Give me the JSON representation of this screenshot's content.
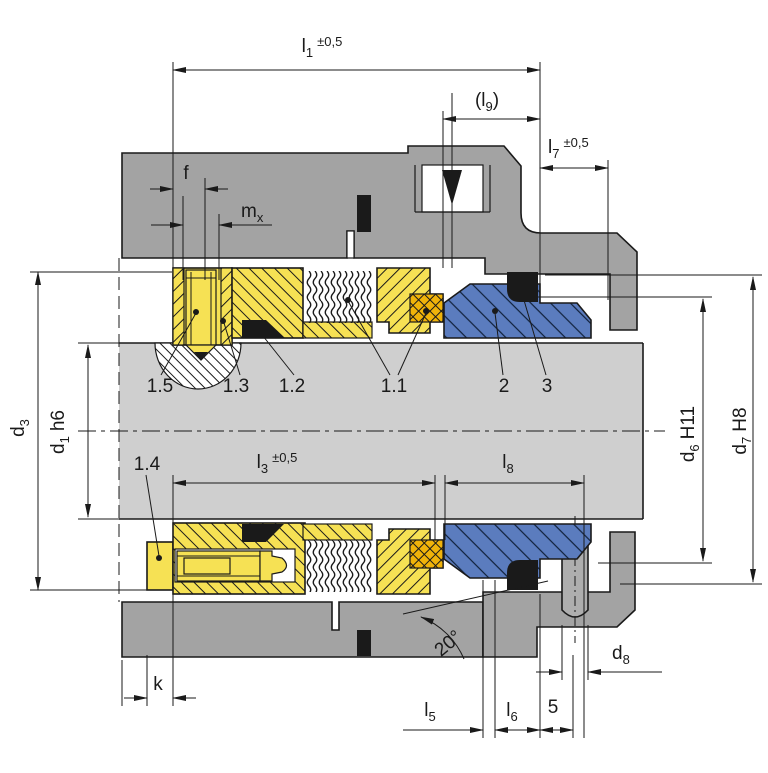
{
  "title": "Mechanical seal sectional drawing",
  "dims": {
    "l1": {
      "base": "l",
      "sub": "1",
      "tol": "±0,5"
    },
    "l9": {
      "pre": "(l",
      "sub": "9",
      "post": ")"
    },
    "l7": {
      "base": "l",
      "sub": "7",
      "tol": "±0,5"
    },
    "l3": {
      "base": "l",
      "sub": "3",
      "tol": "±0,5"
    },
    "l8": {
      "base": "l",
      "sub": "8"
    },
    "l5": {
      "base": "l",
      "sub": "5"
    },
    "l6": {
      "base": "l",
      "sub": "6"
    },
    "dim5": {
      "label": "5"
    },
    "k": {
      "label": "k"
    },
    "f": {
      "label": "f"
    },
    "mx": {
      "base": "m",
      "sub": "x"
    },
    "d3": {
      "base": "d",
      "sub": "3"
    },
    "d1": {
      "base": "d",
      "sub": "1",
      "fit": "h6"
    },
    "d6": {
      "base": "d",
      "sub": "6",
      "fit": "H11"
    },
    "d7": {
      "base": "d",
      "sub": "7",
      "fit": "H8"
    },
    "d8": {
      "base": "d",
      "sub": "8"
    },
    "angle": {
      "label": "20°"
    }
  },
  "parts": {
    "item_1_1": "1.1",
    "item_1_2": "1.2",
    "item_1_3": "1.3",
    "item_1_4": "1.4",
    "item_1_5": "1.5",
    "item_2": "2",
    "item_3": "3"
  },
  "colors": {
    "housing": "#a3a3a3",
    "shaft": "#cfcfcf",
    "metal_yellow": "#f6e154",
    "elastomer_orange": "#f0b30a",
    "seat_blue": "#5b7cbe",
    "detail_black": "#1a1a1a",
    "pin_gray": "#aeaeae"
  }
}
